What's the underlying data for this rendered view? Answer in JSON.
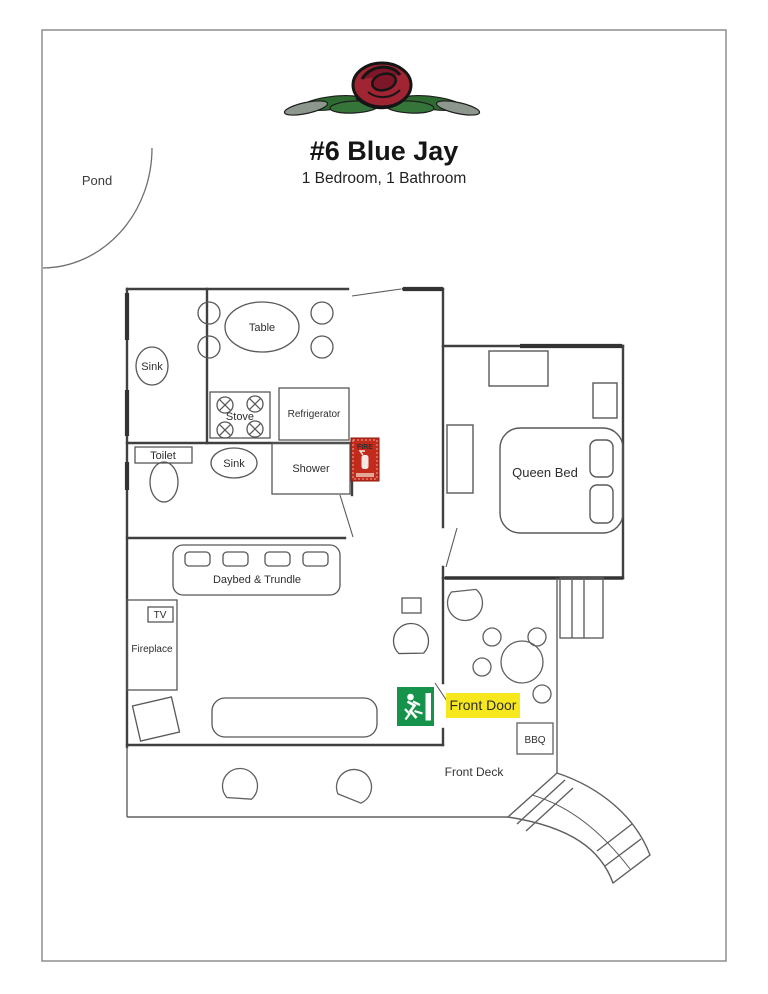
{
  "header": {
    "title": "#6 Blue Jay",
    "subtitle": "1 Bedroom, 1 Bathroom"
  },
  "labels": {
    "pond": "Pond",
    "table": "Table",
    "sink_closet": "Sink",
    "stove": "Stove",
    "refrigerator": "Refrigerator",
    "toilet": "Toilet",
    "sink_bath": "Sink",
    "shower": "Shower",
    "fire_sign": "FIRE",
    "queen_bed": "Queen Bed",
    "daybed_trundle": "Daybed & Trundle",
    "tv": "TV",
    "fireplace": "Fireplace",
    "front_door": "Front Door",
    "bbq": "BBQ",
    "front_deck": "Front Deck"
  },
  "icons": {
    "rose-logo": "red rose bloom over evergreen fronds",
    "exit-running-man-icon": "green emergency-exit sign with white running figure",
    "fire-extinguisher-icon": "red fire extinguisher wall stamp"
  },
  "colors": {
    "front_door_highlight": "#F7E81E",
    "exit_sign_green": "#16934A",
    "fire_sign_red": "#C22B1C",
    "rose_red": "#A12433",
    "frond_green": "#2E6B30",
    "wall_gray": "#404040",
    "page_border": "#8D8D8D"
  }
}
